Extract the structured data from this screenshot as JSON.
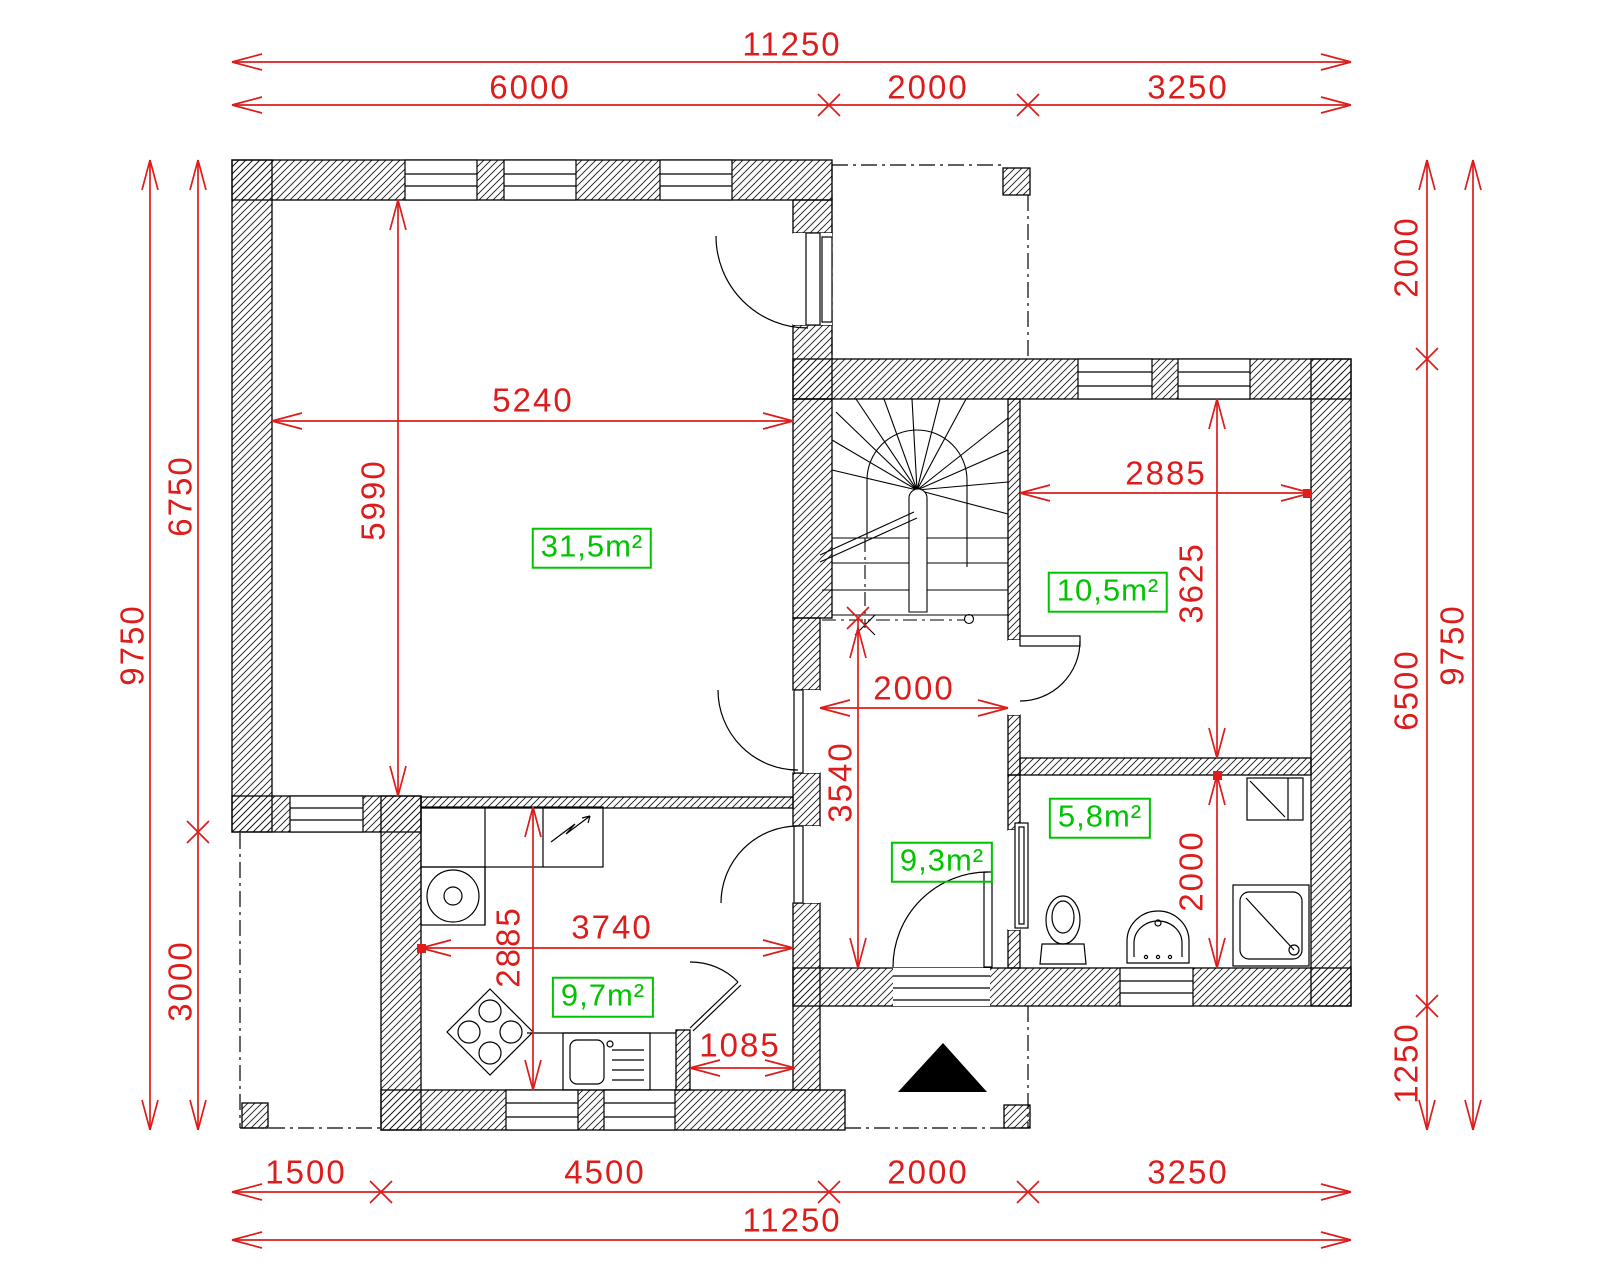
{
  "drawing": {
    "type": "floor-plan",
    "colors": {
      "dimension_red": "#dd1c1c",
      "area_green": "#00c400",
      "line_black": "#000000",
      "background": "#ffffff"
    },
    "dims": {
      "top_total": "11250",
      "top_1": "6000",
      "top_2": "2000",
      "top_3": "3250",
      "bottom_1": "1500",
      "bottom_2": "4500",
      "bottom_3": "2000",
      "bottom_4": "3250",
      "bottom_total": "11250",
      "left_total": "9750",
      "left_1": "6750",
      "left_2": "3000",
      "right_1": "2000",
      "right_2": "6500",
      "right_3": "1250",
      "right_total": "9750",
      "living_w": "5240",
      "living_d": "5990",
      "bedroom_w": "2885",
      "bedroom_d": "3625",
      "hall_w": "2000",
      "hall_d": "3540",
      "kitchen_w": "3740",
      "kitchen_d": "2885",
      "pantry_w": "1085",
      "bathroom_d": "2000"
    },
    "areas": {
      "living": "31,5m²",
      "bedroom": "10,5m²",
      "bathroom": "5,8m²",
      "hall": "9,3m²",
      "kitchen": "9,7m²"
    }
  }
}
